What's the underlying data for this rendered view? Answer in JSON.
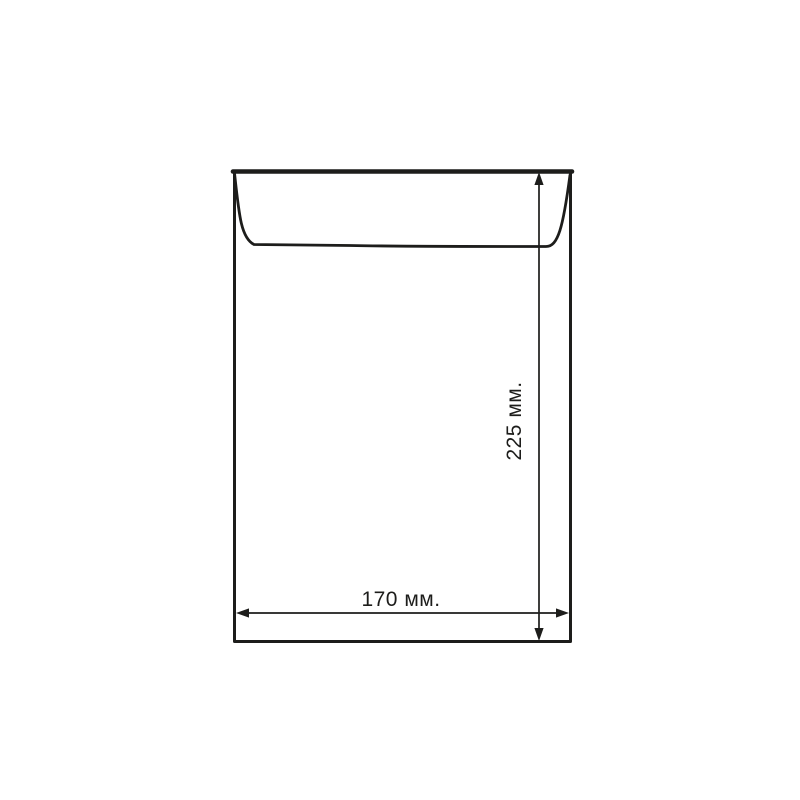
{
  "page": {
    "background_color": "#ffffff"
  },
  "diagram": {
    "stroke_color": "#1d1d1b",
    "text_color": "#1d1d1b",
    "height_dimension": {
      "label": "225 мм."
    },
    "width_dimension": {
      "label": "170 мм."
    }
  }
}
